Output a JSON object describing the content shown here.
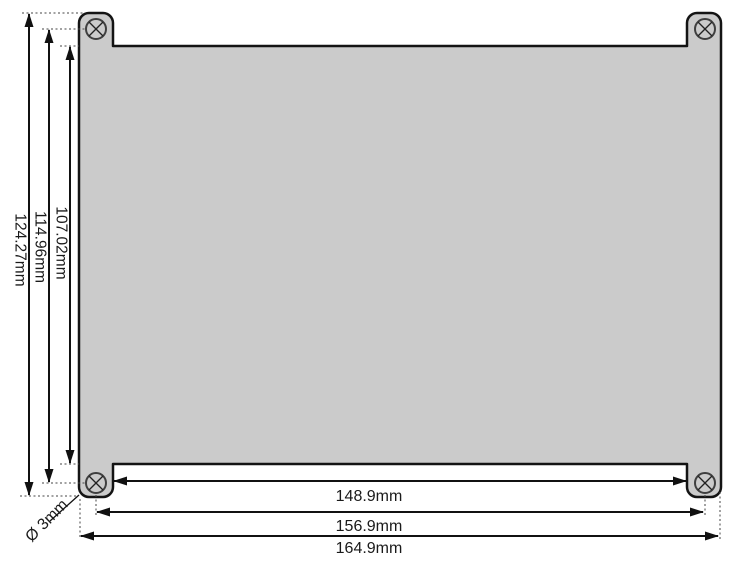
{
  "colors": {
    "panel_fill": "#cbcbcb",
    "outline": "#141414",
    "dim_line": "#111111",
    "hole_stroke": "#3f3f3f",
    "leader_dotted": "#444444"
  },
  "dimensions": {
    "vertical": [
      "124.27mm",
      "114.96mm",
      "107.02mm"
    ],
    "horizontal": [
      "148.9mm",
      "156.9mm",
      "164.9mm"
    ],
    "hole_diameter": "Ø 3mm"
  }
}
